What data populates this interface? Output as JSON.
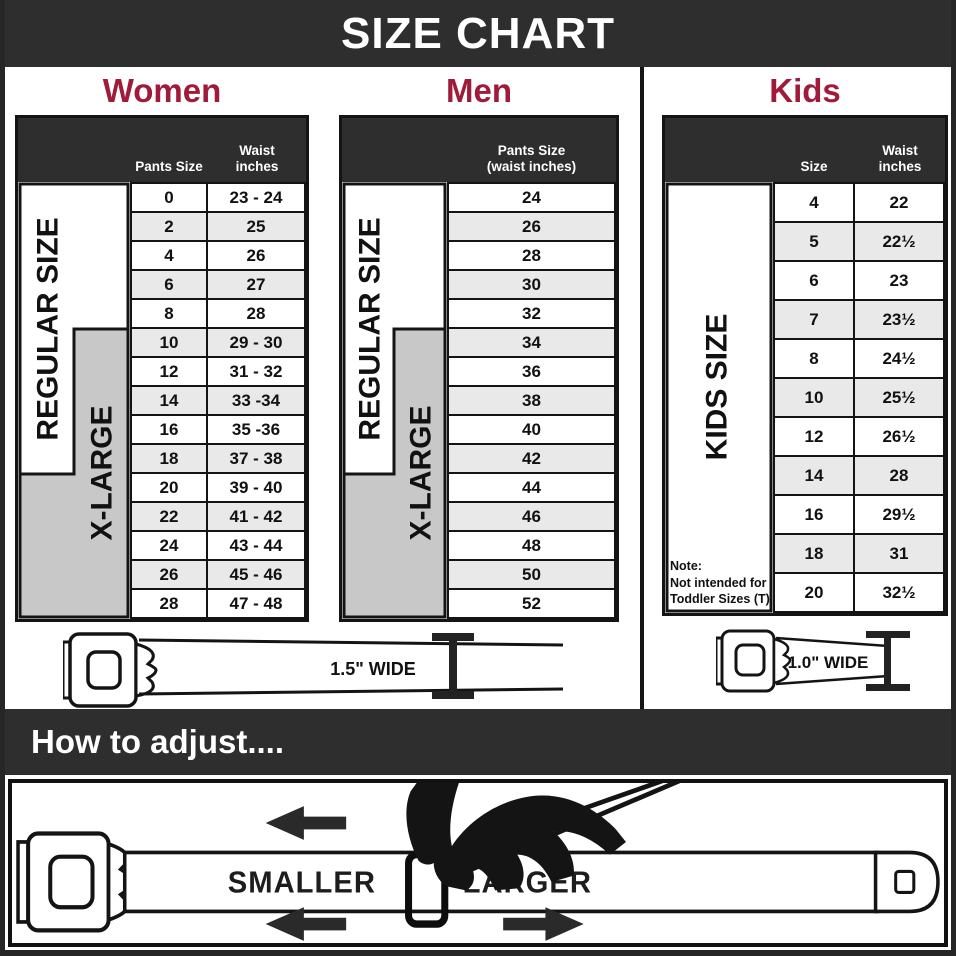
{
  "banner": {
    "title": "SIZE CHART"
  },
  "colors": {
    "accent": "#A01B3A",
    "band": "#2E2E2E",
    "xlarge_gray": "#C8C8C8",
    "row_alt": "#E9E9E9"
  },
  "women": {
    "title": "Women",
    "headers": {
      "col1": "Pants Size",
      "col2_line1": "Waist",
      "col2_line2": "inches"
    },
    "labels": {
      "regular": "REGULAR SIZE",
      "xlarge": "X-LARGE"
    },
    "rows": [
      {
        "size": "0",
        "waist": "23 - 24"
      },
      {
        "size": "2",
        "waist": "25"
      },
      {
        "size": "4",
        "waist": "26"
      },
      {
        "size": "6",
        "waist": "27"
      },
      {
        "size": "8",
        "waist": "28"
      },
      {
        "size": "10",
        "waist": "29 - 30"
      },
      {
        "size": "12",
        "waist": "31 - 32"
      },
      {
        "size": "14",
        "waist": "33 -34"
      },
      {
        "size": "16",
        "waist": "35 -36"
      },
      {
        "size": "18",
        "waist": "37 - 38"
      },
      {
        "size": "20",
        "waist": "39 - 40"
      },
      {
        "size": "22",
        "waist": "41 - 42"
      },
      {
        "size": "24",
        "waist": "43 - 44"
      },
      {
        "size": "26",
        "waist": "45 - 46"
      },
      {
        "size": "28",
        "waist": "47 - 48"
      }
    ]
  },
  "men": {
    "title": "Men",
    "headers": {
      "col_line1": "Pants Size",
      "col_line2": "(waist inches)"
    },
    "labels": {
      "regular": "REGULAR SIZE",
      "xlarge": "X-LARGE"
    },
    "rows": [
      "24",
      "26",
      "28",
      "30",
      "32",
      "34",
      "36",
      "38",
      "40",
      "42",
      "44",
      "46",
      "48",
      "50",
      "52"
    ]
  },
  "kids": {
    "title": "Kids",
    "headers": {
      "col1": "Size",
      "col2_line1": "Waist",
      "col2_line2": "inches"
    },
    "labels": {
      "kids": "KIDS SIZE"
    },
    "note": {
      "line1": "Note:",
      "line2": "Not intended for",
      "line3": "Toddler Sizes (T)"
    },
    "rows": [
      {
        "size": "4",
        "waist": "22"
      },
      {
        "size": "5",
        "waist": "22½"
      },
      {
        "size": "6",
        "waist": "23"
      },
      {
        "size": "7",
        "waist": "23½"
      },
      {
        "size": "8",
        "waist": "24½"
      },
      {
        "size": "10",
        "waist": "25½"
      },
      {
        "size": "12",
        "waist": "26½"
      },
      {
        "size": "14",
        "waist": "28"
      },
      {
        "size": "16",
        "waist": "29½"
      },
      {
        "size": "18",
        "waist": "31"
      },
      {
        "size": "20",
        "waist": "32½"
      }
    ]
  },
  "belts": {
    "adult_width_label": "1.5\" WIDE",
    "kids_width_label": "1.0\" WIDE"
  },
  "adjust": {
    "heading": "How to adjust....",
    "smaller": "SMALLER",
    "larger": "LARGER"
  }
}
